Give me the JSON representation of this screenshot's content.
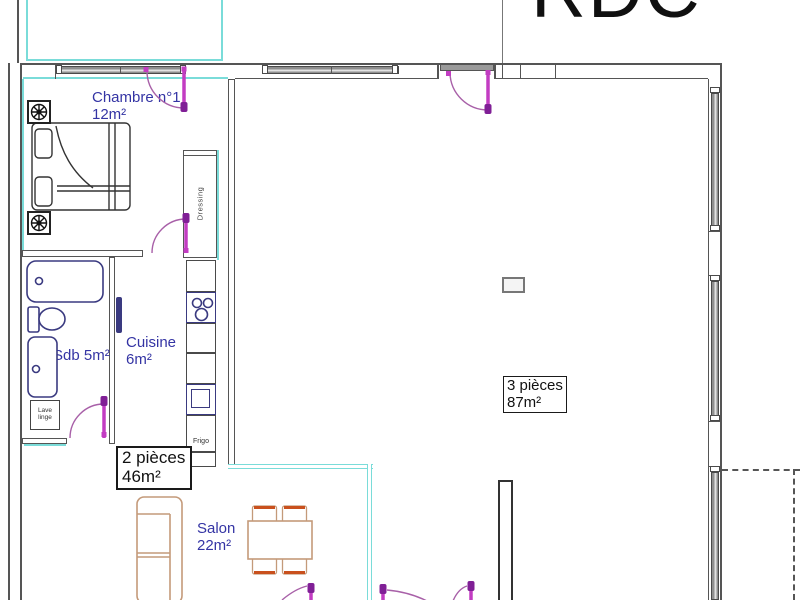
{
  "title": "RDC",
  "labels": {
    "chambre_name": "Chambre n°1",
    "chambre_area": "12m²",
    "sdb": "Sdb 5m²",
    "cuisine_name": "Cuisine",
    "cuisine_area": "6m²",
    "salon_name": "Salon",
    "salon_area": "22m²",
    "zone2_name": "2 pièces",
    "zone2_area": "46m²",
    "zone3_name": "3 pièces",
    "zone3_area": "87m²",
    "dressing": "Dressing",
    "frigo": "Frigo",
    "lave_linge": "Lave linge"
  },
  "colors": {
    "wall_line": "#555555",
    "new_wall_cyan": "#7adcd9",
    "room_label_blue": "#3434a4",
    "door_leaf_magenta": "#c23cc2",
    "door_arc_purple": "#a860a8",
    "door_handle_purple": "#801f96",
    "sanitary_navy": "#3a3a80",
    "furniture_tan": "#c49a7a",
    "chair_orange": "#c9501d",
    "glazing_gray": "#8f8f8f",
    "title_black": "#101010"
  }
}
